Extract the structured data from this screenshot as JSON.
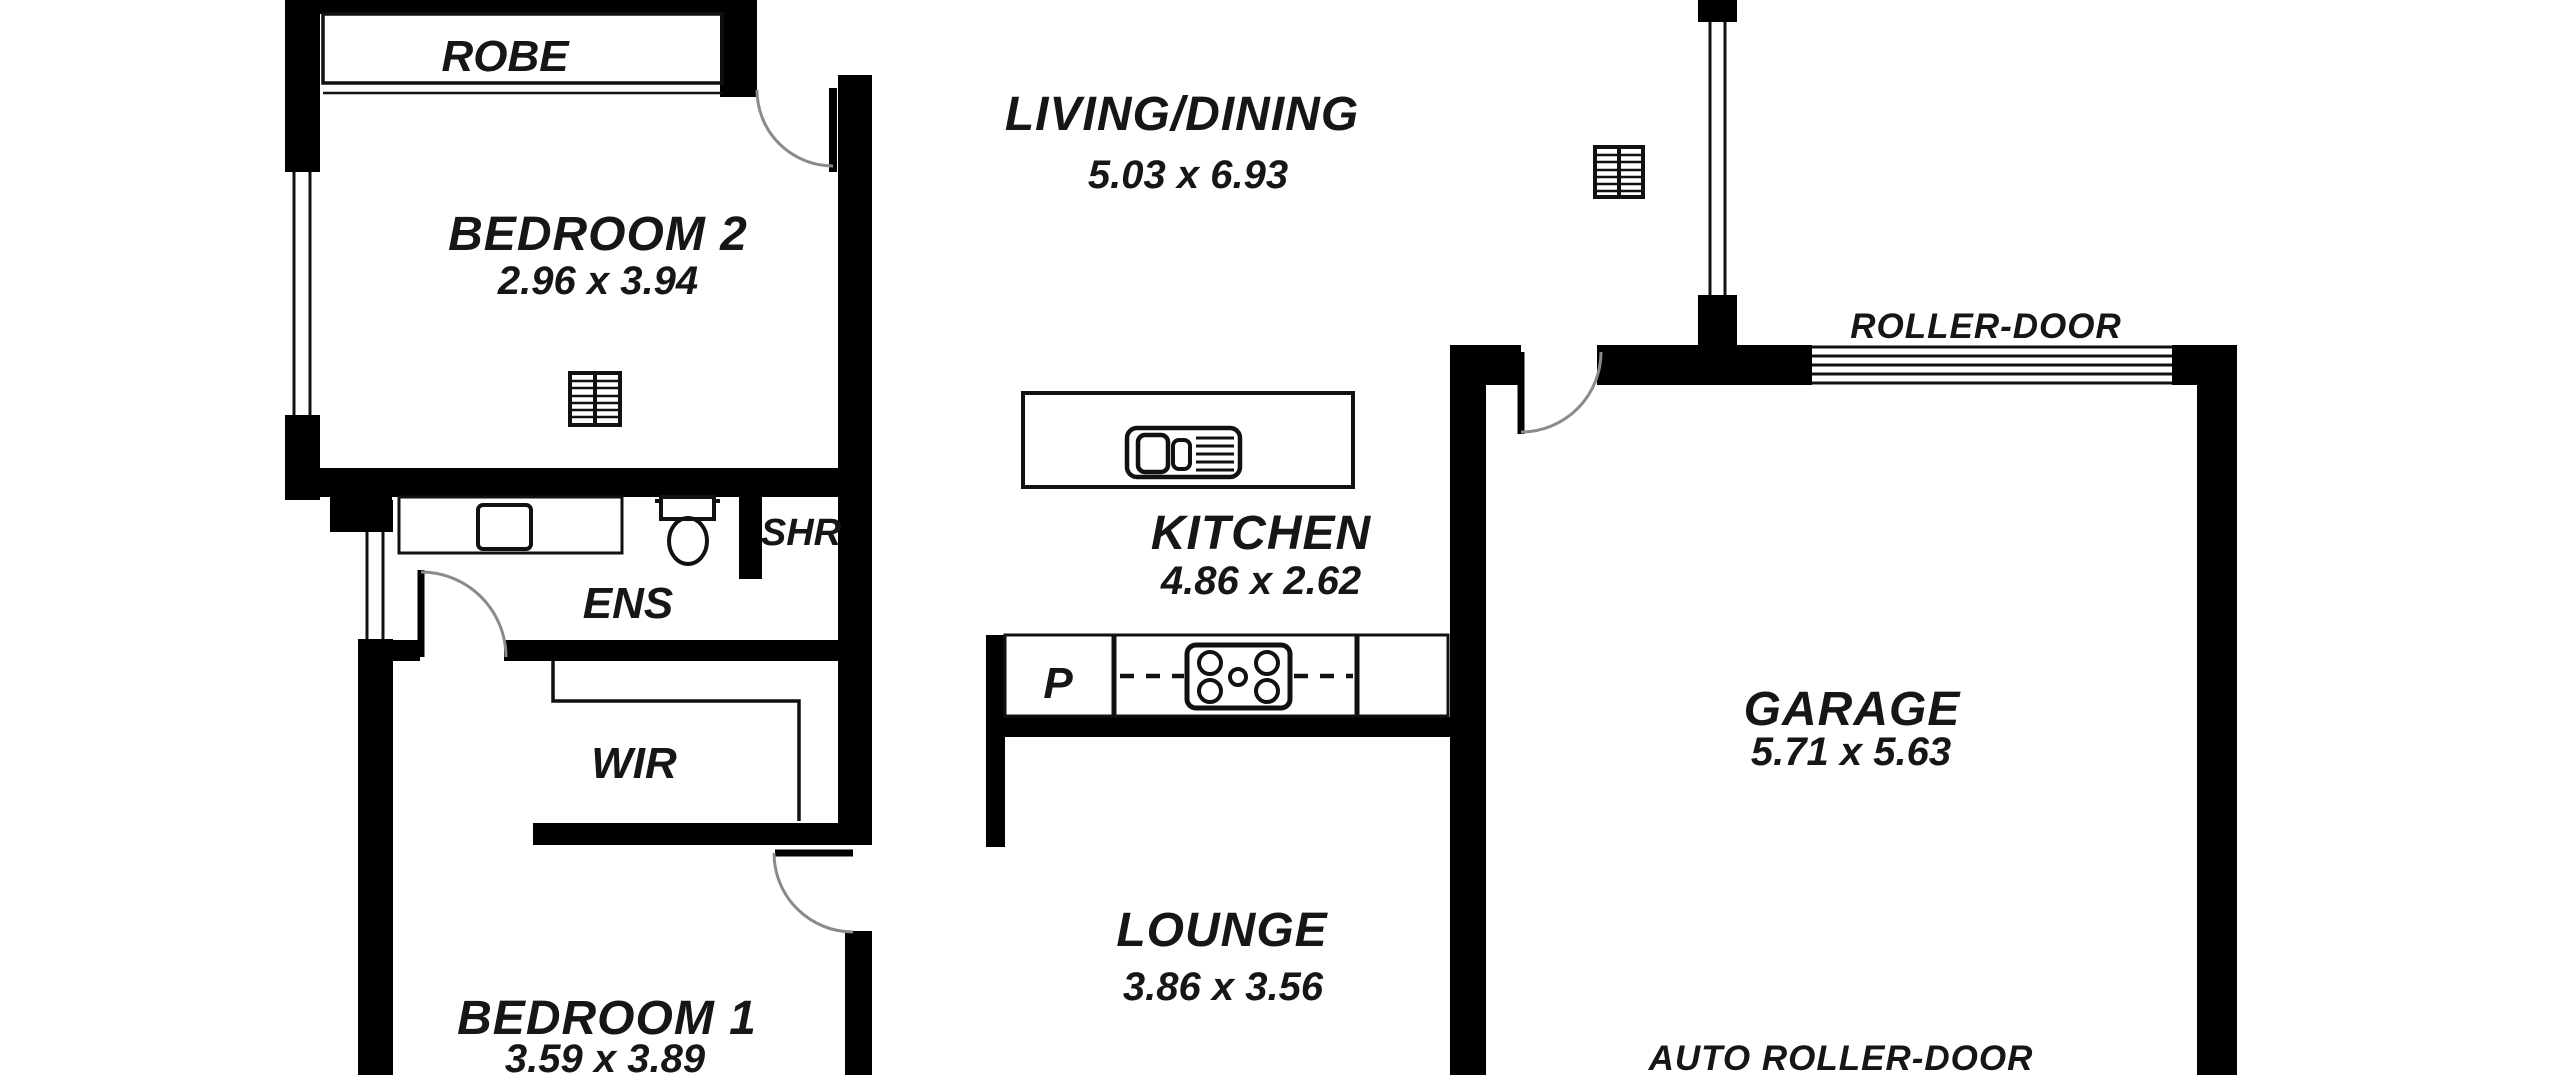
{
  "plan": {
    "type": "residential-floor-plan",
    "rooms": [
      {
        "name": "bedroom-2",
        "label": "BEDROOM 2",
        "dimensions": "2.96 x 3.94"
      },
      {
        "name": "living-dining",
        "label": "LIVING/DINING",
        "dimensions": "5.03 x 6.93"
      },
      {
        "name": "kitchen",
        "label": "KITCHEN",
        "dimensions": "4.86 x 2.62"
      },
      {
        "name": "lounge",
        "label": "LOUNGE",
        "dimensions": "3.86 x 3.56"
      },
      {
        "name": "bedroom-1",
        "label": "BEDROOM 1",
        "dimensions": "3.59 x 3.89"
      },
      {
        "name": "garage",
        "label": "GARAGE",
        "dimensions": "5.71 x 5.63"
      }
    ],
    "zones": [
      {
        "name": "robe",
        "label": "ROBE"
      },
      {
        "name": "ensuite",
        "label": "ENS"
      },
      {
        "name": "shower",
        "label": "SHR"
      },
      {
        "name": "walk-in-robe",
        "label": "WIR"
      },
      {
        "name": "pantry",
        "label": "P"
      }
    ],
    "annotations": [
      {
        "name": "roller-door",
        "label": "ROLLER-DOOR"
      },
      {
        "name": "auto-roller-door",
        "label": "AUTO ROLLER-DOOR"
      }
    ],
    "colors": {
      "background": "#ffffff",
      "wall": "#000000",
      "text": "#161616",
      "door_arc": "#8a8a8a",
      "fixture_line": "#111111"
    }
  }
}
